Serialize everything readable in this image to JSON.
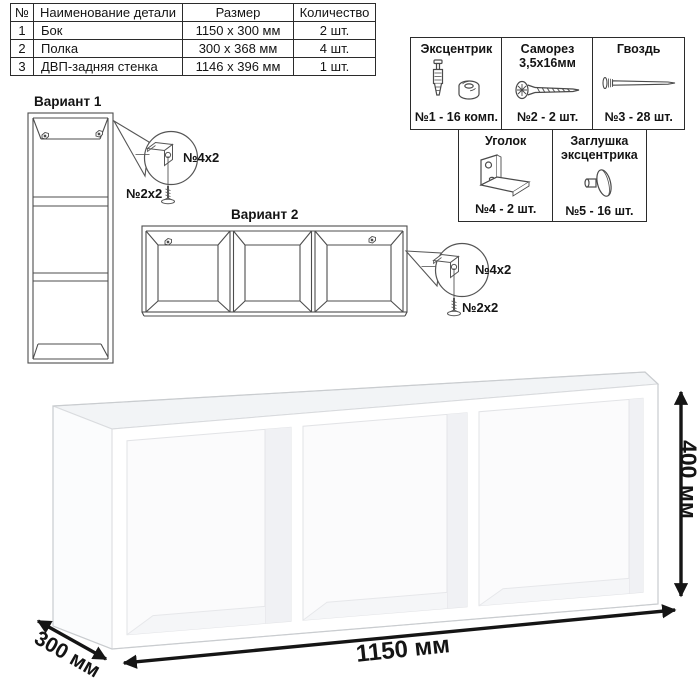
{
  "parts_table": {
    "headers": {
      "num": "№",
      "name": "Наименование детали",
      "size": "Размер",
      "qty": "Количество"
    },
    "rows": [
      {
        "num": "1",
        "name": "Бок",
        "size": "1150 х 300 мм",
        "qty": "2 шт."
      },
      {
        "num": "2",
        "name": "Полка",
        "size": "300 х 368 мм",
        "qty": "4 шт."
      },
      {
        "num": "3",
        "name": "ДВП-задняя стенка",
        "size": "1146 х 396 мм",
        "qty": "1 шт."
      }
    ]
  },
  "hardware": {
    "items": [
      {
        "title": "Эксцентрик",
        "count": "№1 - 16 комп.",
        "icon": "cam-bolt-and-cam-icon"
      },
      {
        "title": "Саморез 3,5х16мм",
        "count": "№2 - 2 шт.",
        "icon": "screw-icon"
      },
      {
        "title": "Гвоздь",
        "count": "№3 - 28 шт.",
        "icon": "nail-icon"
      },
      {
        "title": "Уголок",
        "count": "№4 - 2 шт.",
        "icon": "corner-bracket-icon"
      },
      {
        "title": "Заглушка эксцентрика",
        "count": "№5 - 16 шт.",
        "icon": "cam-cap-icon"
      }
    ]
  },
  "variants": {
    "v1": {
      "label": "Вариант 1",
      "bracket_qty": "№4х2",
      "screw_qty": "№2х2"
    },
    "v2": {
      "label": "Вариант 2",
      "bracket_qty": "№4х2",
      "screw_qty": "№2х2"
    }
  },
  "dimensions": {
    "width": "1150 мм",
    "depth": "300 мм",
    "height": "400 мм"
  },
  "colors": {
    "line_art": "#4d4d4d",
    "border": "#2b2b2b",
    "text": "#141414",
    "arrow": "#151515",
    "shelf_top": "#f2f4f6",
    "shelf_front": "#ffffff"
  }
}
